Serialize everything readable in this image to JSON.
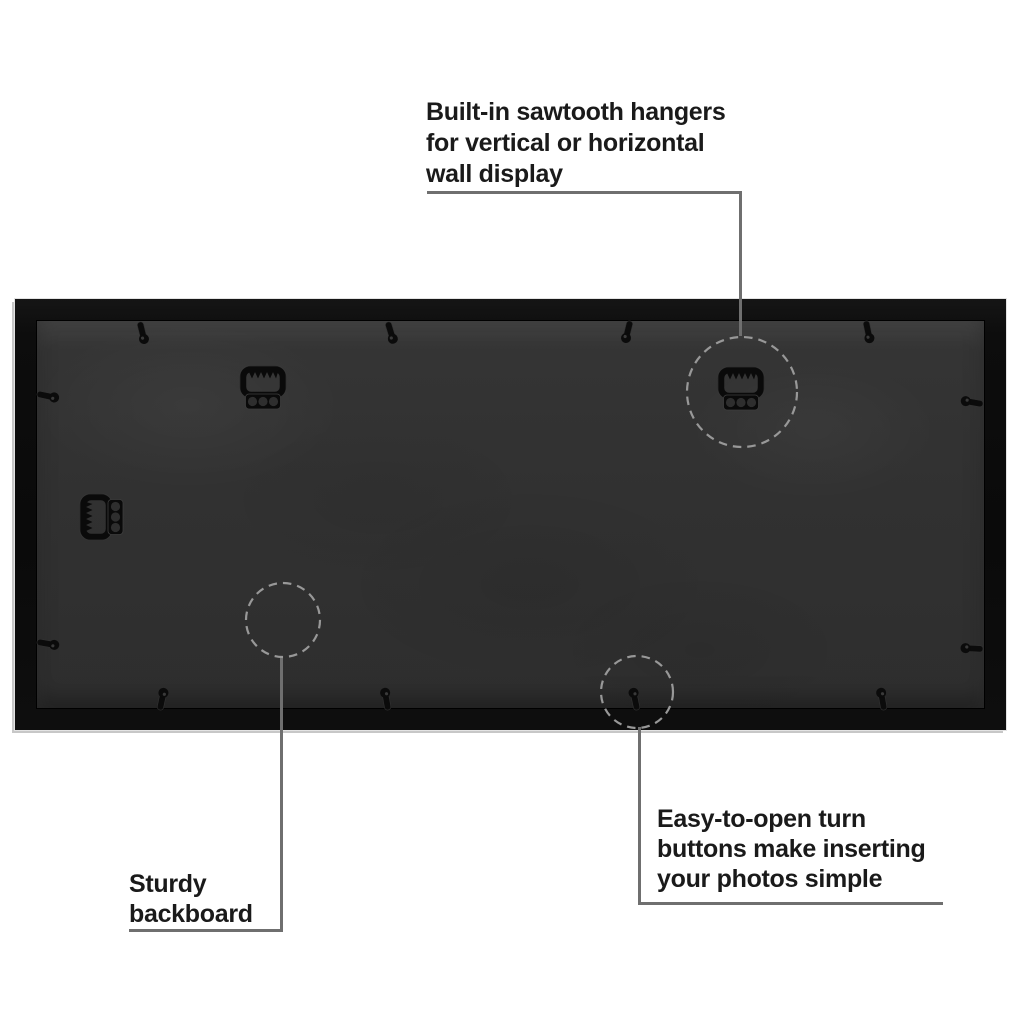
{
  "colors": {
    "background": "#ffffff",
    "frame": "#0d0d0d",
    "backboard": "#313131",
    "callout_line": "#6f6f6f",
    "highlight_dash": "#989898",
    "text": "#1a1a1a",
    "hardware": "#0a0a0a"
  },
  "icons": {
    "sawtooth_hanger": "sawtooth-hanger-icon",
    "turn_button": "turn-button-icon",
    "highlight_circle": "dashed-highlight-circle"
  },
  "callouts": {
    "hangers": {
      "lines": [
        "Built-in sawtooth hangers",
        "for vertical or horizontal",
        "wall display"
      ]
    },
    "backboard": {
      "lines": [
        "Sturdy",
        "backboard"
      ]
    },
    "turn_buttons": {
      "lines": [
        "Easy-to-open turn",
        "buttons make inserting",
        "your photos simple"
      ]
    }
  }
}
